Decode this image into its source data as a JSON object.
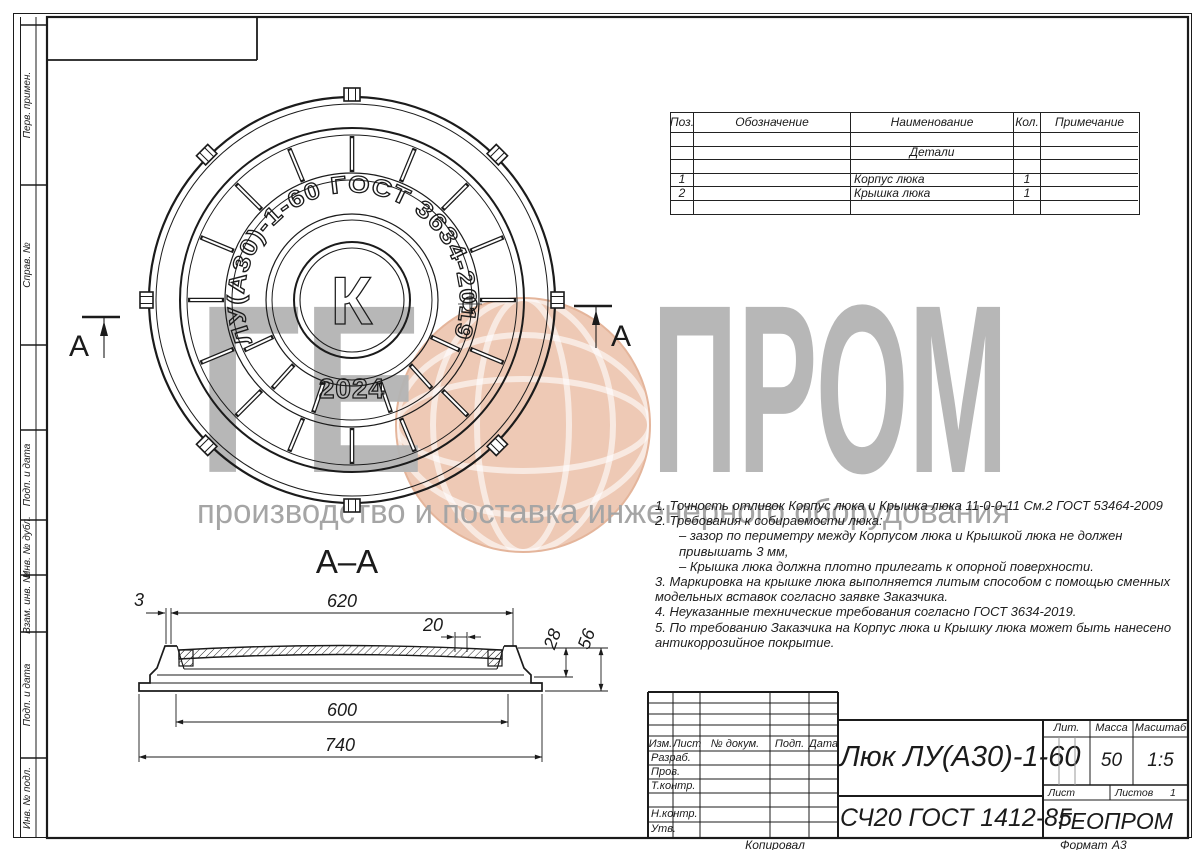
{
  "page": {
    "bg": "#ffffff",
    "ink": "#1b1b1b"
  },
  "watermark": {
    "left": "ГЕ",
    "right": "ПРОМ",
    "subtitle": "производство и поставка инженерного оборудования",
    "text_color": "#b4b4b4",
    "globe_color": "#edc4ad"
  },
  "margin_stamps": [
    "Перв. примен.",
    "Справ. №",
    "Подп. и дата",
    "Инв. № дубл.",
    "Взам. инв. №",
    "Подп. и дата",
    "Инв. № подл."
  ],
  "footer": {
    "copied": "Копировал",
    "format_label": "Формат",
    "format_value": "А3"
  },
  "parts_table": {
    "headers": [
      "Поз.",
      "Обозначение",
      "Наименование",
      "Кол.",
      "Примечание"
    ],
    "group_label": "Детали",
    "rows": [
      {
        "pos": "1",
        "name": "Корпус люка",
        "qty": "1"
      },
      {
        "pos": "2",
        "name": "Крышка люка",
        "qty": "1"
      }
    ]
  },
  "cover_view": {
    "arc_text": "ЛУ(А30)-1-60  ГОСТ 3634-2019",
    "center_mark": "К",
    "year": "2024",
    "cut_label_left": "А",
    "cut_label_right": "А"
  },
  "section_view": {
    "title": "А–А",
    "dim_3": "3",
    "dim_620": "620",
    "dim_20": "20",
    "dim_28": "28",
    "dim_56": "56",
    "dim_600": "600",
    "dim_740": "740"
  },
  "notes": [
    "1. Точность отливок Корпус люка и Крышка люка 11-0-0-11 См.2 ГОСТ 53464-2009",
    "2. Требования к собираемости люка:",
    "– зазор по периметру между Корпусом люка и Крышкой люка не должен привышать 3 мм,",
    "– Крышка люка должна плотно прилегать к опорной поверхности.",
    "3. Маркировка на крышке люка выполняется литым способом с помощью сменных модельных вставок согласно заявке Заказчика.",
    "4. Неуказанные технические требования согласно ГОСТ 3634-2019.",
    "5. По требованию Заказчика на Корпус люка и Крышку люка может быть нанесено антикоррозийное покрытие."
  ],
  "title_block": {
    "rev_headers": [
      "Изм.",
      "Лист",
      "№ докум.",
      "Подп.",
      "Дата"
    ],
    "sign_rows": [
      "Разраб.",
      "Пров.",
      "Т.контр.",
      "",
      "Н.контр.",
      "Утв."
    ],
    "doc_title": "Люк ЛУ(А30)-1-60",
    "material": "СЧ20 ГОСТ 1412-85",
    "company": "ГЕОПРОМ",
    "lit_label": "Лит.",
    "mass_label": "Масса",
    "mass_value": "50",
    "scale_label": "Масштаб",
    "scale_value": "1:5",
    "sheet_label": "Лист",
    "sheets_label": "Листов",
    "sheets_value": "1"
  }
}
